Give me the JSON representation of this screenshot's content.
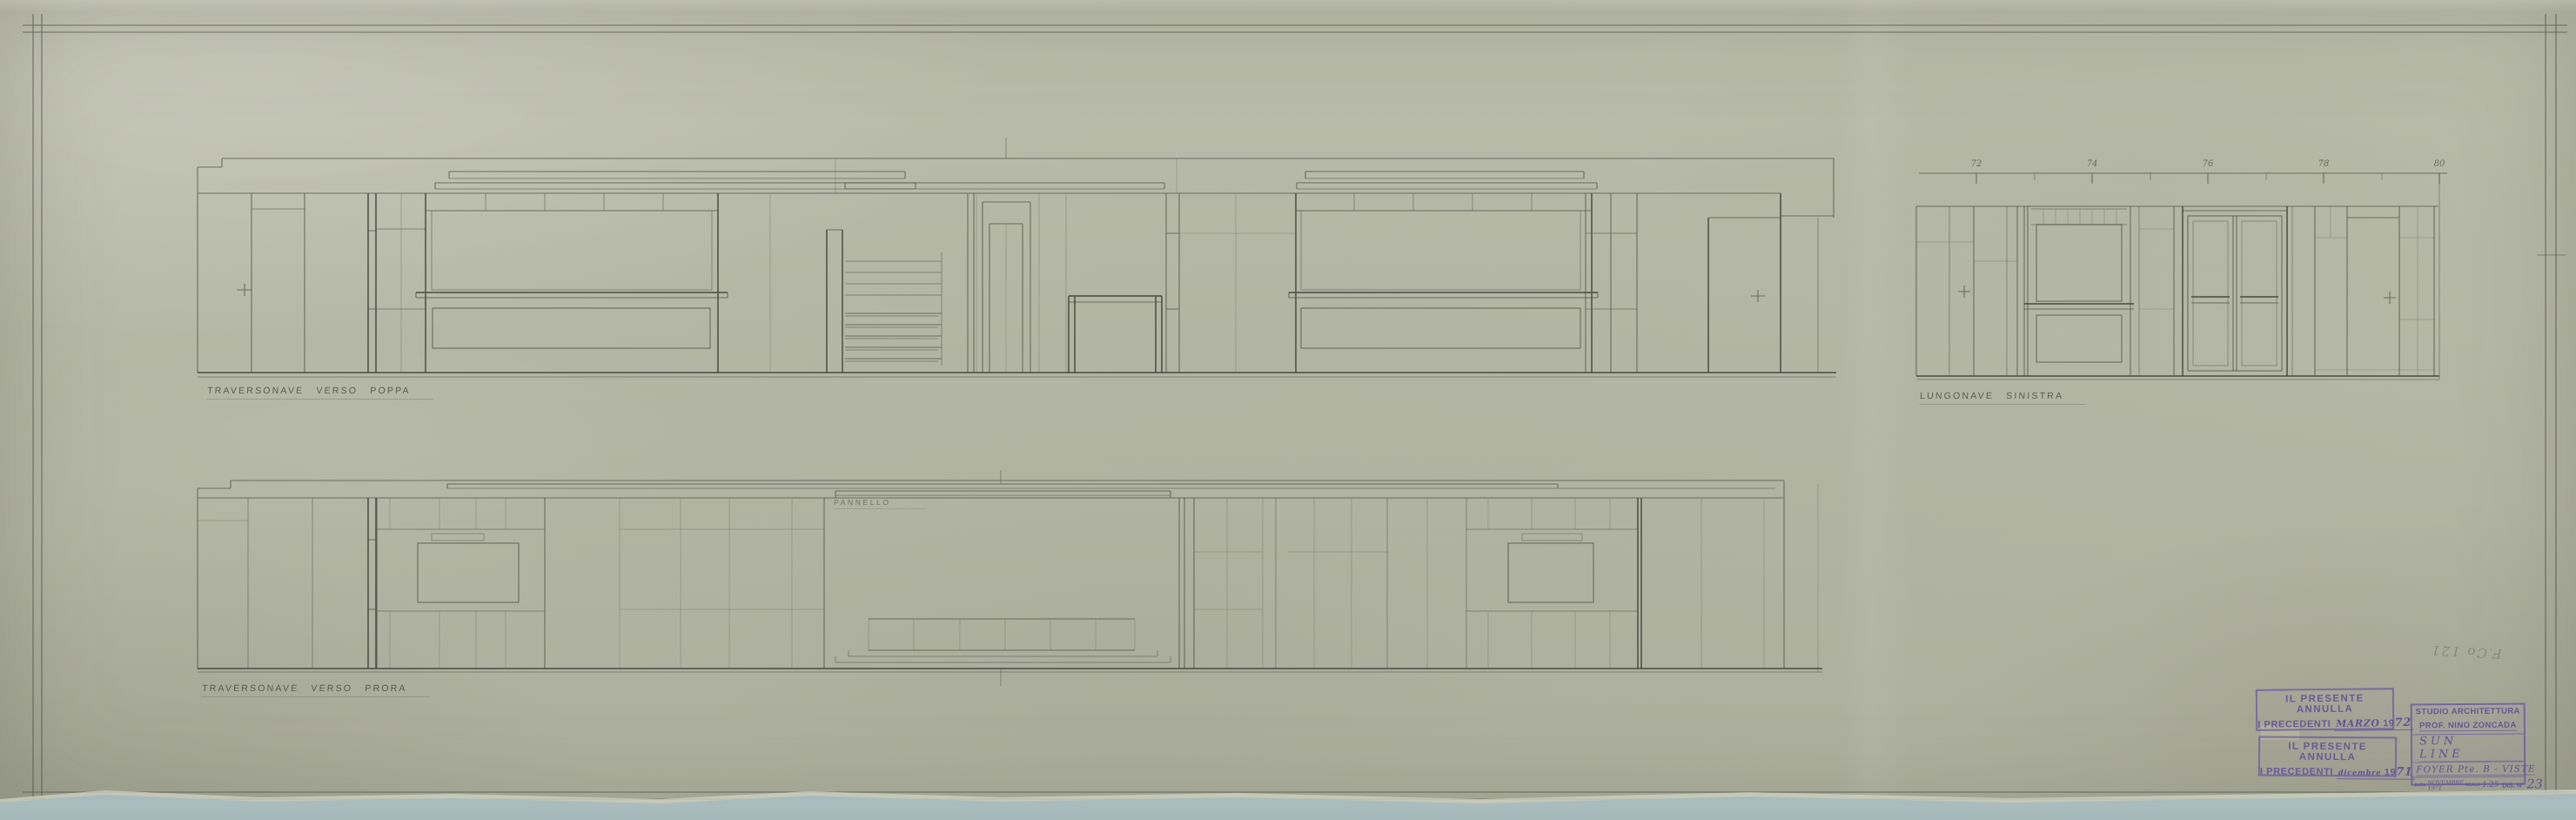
{
  "captions": {
    "top": "TRAVERSONAVE  VERSO  POPPA",
    "side": "LUNGONAVE  SINISTRA",
    "bottom": "TRAVERSONAVE  VERSO  PRORA"
  },
  "labels": {
    "panel": "PANNELLO",
    "pencil_note": "F.Co 121"
  },
  "ruler": {
    "labels": [
      "72",
      "74",
      "76",
      "78",
      "80"
    ]
  },
  "stamps": {
    "annulla_march": {
      "line1": "IL PRESENTE ANNULLA",
      "prefix": "I PRECEDENTI",
      "month": "MARZO",
      "year_print": "19",
      "year_hand": "72"
    },
    "annulla_december": {
      "line1": "IL PRESENTE ANNULLA",
      "prefix": "I PRECEDENTI",
      "month": "dicembre",
      "year_print": "19",
      "year_hand": "71"
    }
  },
  "title_block": {
    "studio": "STUDIO ARCHITETTURA",
    "architect": "PROF. NINO ZONCADA",
    "project": "SUN LINE",
    "subject": "FOYER  Pte. B - VISTE",
    "data_label": "DATA",
    "date_month": "NOVEMBRE",
    "date_year": "1971",
    "scala_label": "SCALA",
    "scale": "1:25",
    "dis_label": "DIS. N°",
    "number": "23"
  },
  "colors": {
    "paper": "#b7b9a8",
    "pencil_line": "#4c4d42",
    "stamp_ink": "#6857a0",
    "torn_edge_backing": "#aabdbe"
  }
}
